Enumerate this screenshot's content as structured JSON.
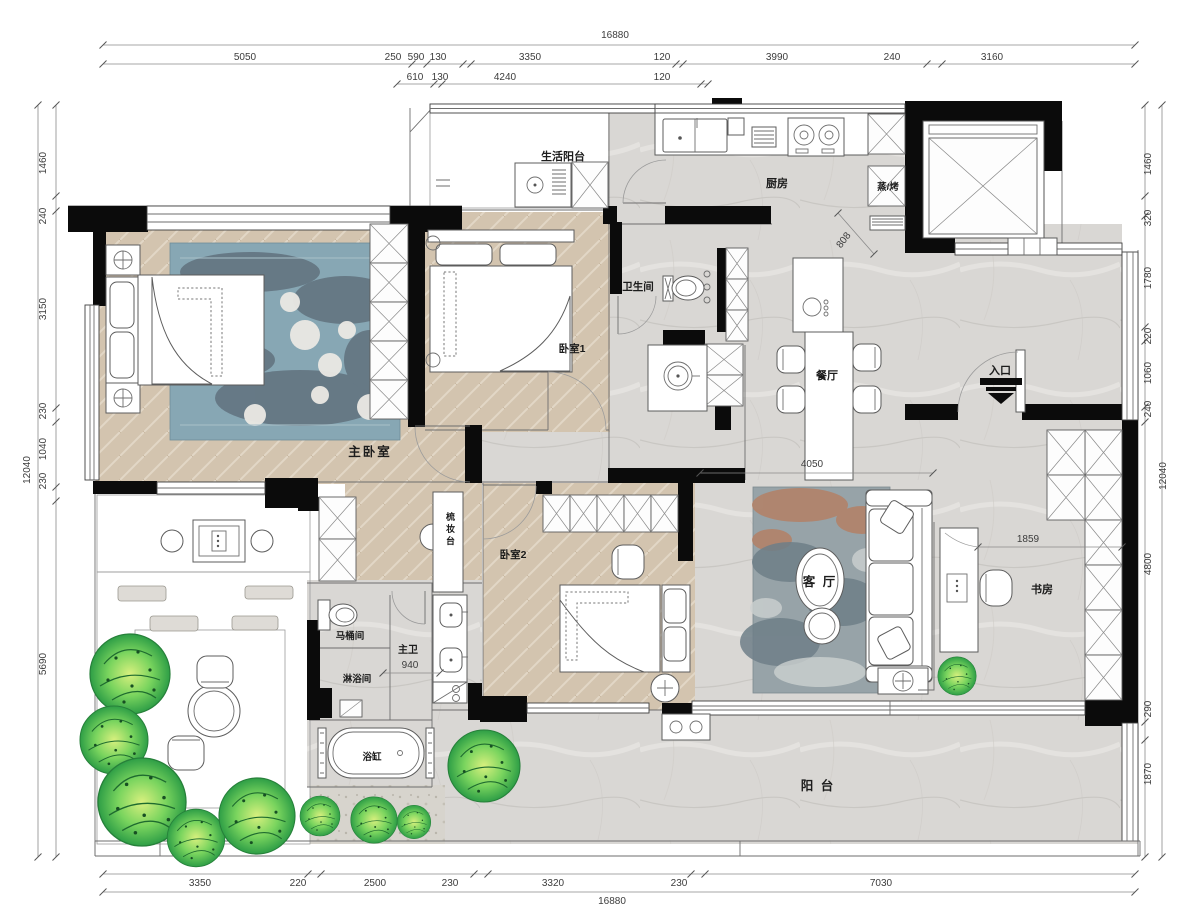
{
  "dims": {
    "top_total": "16880",
    "bottom_total": "16880",
    "left_total": "12040",
    "right_total": "12040",
    "top_row1": [
      "5050",
      "250",
      "590",
      "130",
      "3350",
      "120",
      "3990",
      "240",
      "3160"
    ],
    "top_row2": [
      "610",
      "130",
      "4240",
      "120"
    ],
    "left": [
      "1460",
      "240",
      "3150",
      "230",
      "1040",
      "230",
      "5690"
    ],
    "right": [
      "1460",
      "320",
      "1780",
      "220",
      "1060",
      "240",
      "4800",
      "290",
      "1870"
    ],
    "bottom": [
      "3350",
      "220",
      "2500",
      "230",
      "3320",
      "230",
      "7030"
    ],
    "inner": {
      "living_width": "4050",
      "desk": "1859",
      "bath": "940",
      "kitchen": "808"
    }
  },
  "rooms": {
    "laundry_balcony": "生活阳台",
    "kitchen": "厨房",
    "steam_oven": "蒸/烤",
    "bathroom": "卫生间",
    "bedroom1": "卧室1",
    "dining": "餐厅",
    "entrance": "入口",
    "master_bedroom": "主卧室",
    "vanity": "梳妆台",
    "bedroom2": "卧室2",
    "living": "客 厅",
    "study": "书房",
    "toilet_room": "马桶间",
    "master_bath": "主卫",
    "shower": "淋浴间",
    "bathtub": "浴缸",
    "balcony": "阳 台"
  },
  "colors": {
    "wall": "#0b0b0b",
    "wood": "#d3c4af",
    "tile": "#d9d7d4",
    "deck": "#c79f80",
    "plant_dark": "#2e9e46",
    "plant_light": "#d8f07e",
    "rug_blue": "#87a7b4",
    "rug_living": "#97a3a8"
  }
}
